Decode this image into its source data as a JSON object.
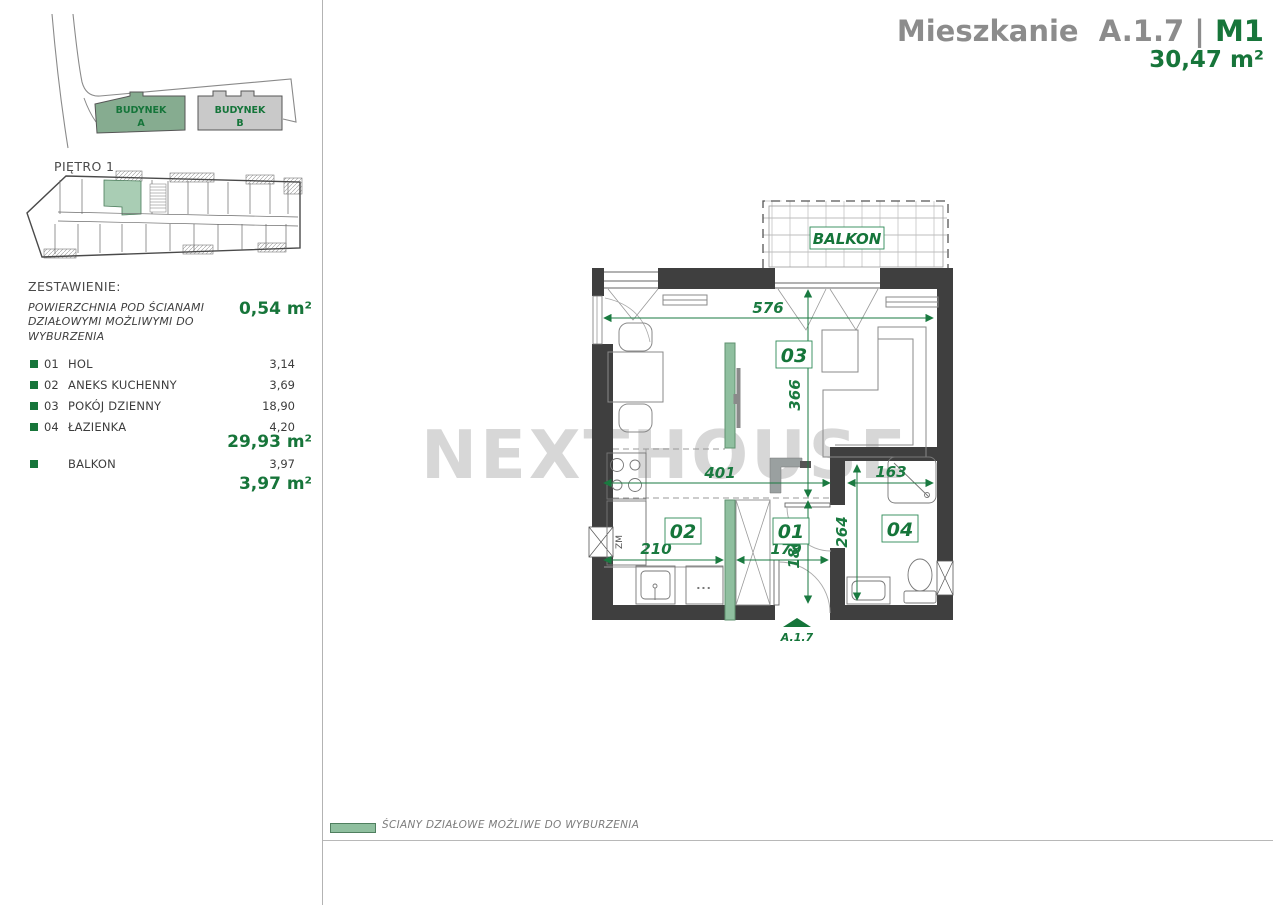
{
  "header": {
    "title_main": "Mieszkanie  A.1.7 | ",
    "title_unit": "M1",
    "area": "30,47 m²"
  },
  "site_plan": {
    "building_a": {
      "line1": "BUDYNEK",
      "line2": "A"
    },
    "building_b": {
      "line1": "BUDYNEK",
      "line2": "B"
    }
  },
  "floor_label": "PIĘTRO 1",
  "summary": {
    "heading": "ZESTAWIENIE:",
    "note": "POWIERZCHNIA POD ŚCIANAMI DZIAŁOWYMI MOŻLIWYMI DO WYBURZENIA",
    "note_value": "0,54 m²",
    "rooms": [
      {
        "no": "01",
        "name": "HOL",
        "area": "3,14"
      },
      {
        "no": "02",
        "name": "ANEKS KUCHENNY",
        "area": "3,69"
      },
      {
        "no": "03",
        "name": "POKÓJ DZIENNY",
        "area": "18,90"
      },
      {
        "no": "04",
        "name": "ŁAZIENKA",
        "area": "4,20"
      }
    ],
    "rooms_total": "29,93 m²",
    "balcony_name": "BALKON",
    "balcony_area": "3,97",
    "balcony_total": "3,97 m²"
  },
  "plan": {
    "balcony_label": "BALKON",
    "entrance_label": "A.1.7",
    "appliance_label": "ZM",
    "drawer_dots": "...",
    "room_labels": {
      "hall": "01",
      "kitchen": "02",
      "living": "03",
      "bath": "04"
    },
    "dims": {
      "top_width": "576",
      "living_depth": "366",
      "mid_width": "401",
      "bath_width": "163",
      "kitchen_width": "210",
      "hall_width": "179",
      "hall_depth": "180",
      "bath_depth": "264"
    }
  },
  "watermark": "NEXTHOUSE",
  "legend": {
    "label": "ŚCIANY DZIAŁOWE MOŻLIWE DO WYBURZENIA"
  },
  "colors": {
    "accent_green": "#17753a",
    "dim_green": "#1a7a40",
    "wall_dark": "#3f3f3f",
    "removable_wall": "#8fbf9f",
    "unit_highlight": "#a9cdb4",
    "title_gray": "#8c8c8c"
  }
}
